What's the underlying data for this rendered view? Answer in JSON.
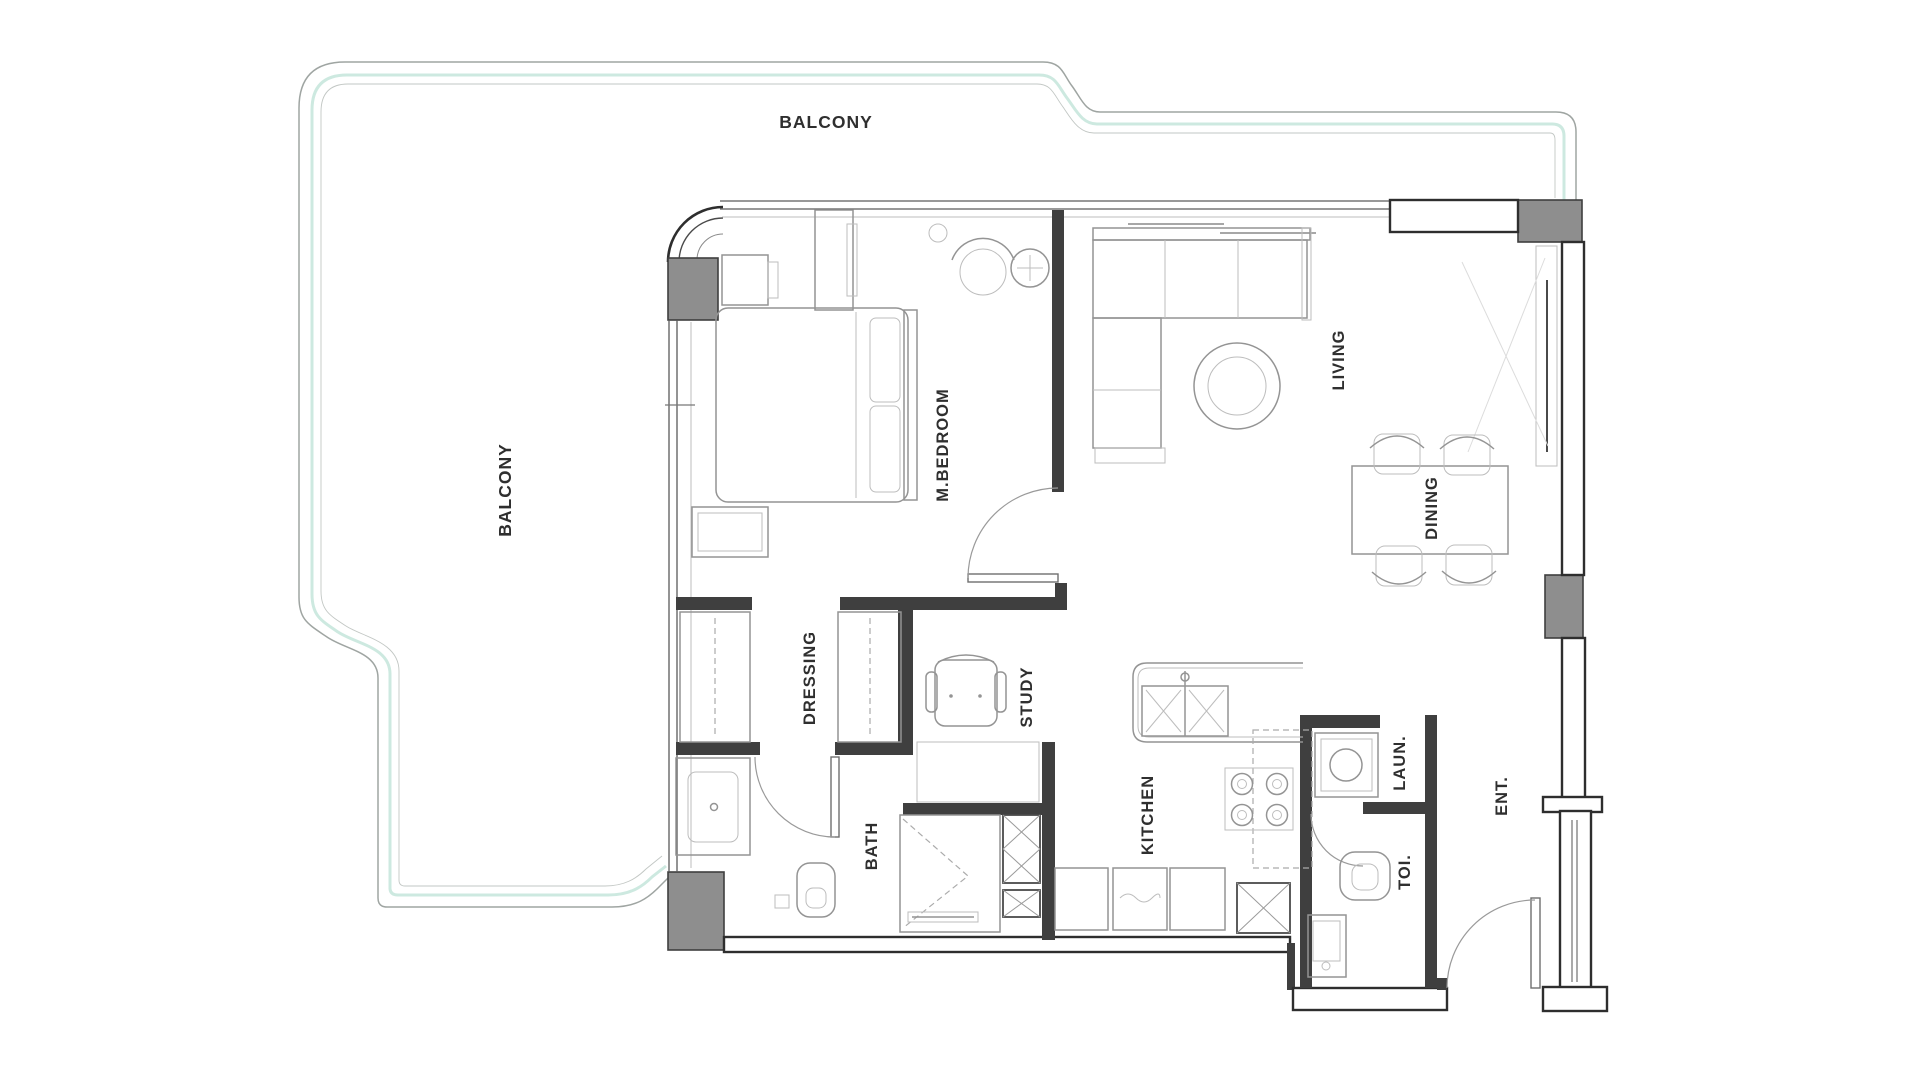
{
  "plan_type": "apartment-floor-plan",
  "rooms": [
    {
      "name": "balcony-top",
      "label": "BALCONY",
      "orientation": "horizontal"
    },
    {
      "name": "balcony-left",
      "label": "BALCONY",
      "orientation": "vertical"
    },
    {
      "name": "m-bedroom",
      "label": "M.BEDROOM",
      "orientation": "vertical"
    },
    {
      "name": "living",
      "label": "LIVING",
      "orientation": "vertical"
    },
    {
      "name": "dining",
      "label": "DINING",
      "orientation": "vertical"
    },
    {
      "name": "dressing",
      "label": "DRESSING",
      "orientation": "vertical"
    },
    {
      "name": "study",
      "label": "STUDY",
      "orientation": "vertical"
    },
    {
      "name": "bath",
      "label": "BATH",
      "orientation": "vertical"
    },
    {
      "name": "kitchen",
      "label": "KITCHEN",
      "orientation": "vertical"
    },
    {
      "name": "laundry",
      "label": "LAUN.",
      "orientation": "vertical"
    },
    {
      "name": "toilet",
      "label": "TOI.",
      "orientation": "vertical"
    },
    {
      "name": "entrance",
      "label": "ENT.",
      "orientation": "vertical"
    }
  ],
  "colors": {
    "background": "#ffffff",
    "wall": "#3f3f3f",
    "column_fill": "#8e8e8e",
    "balcony_rail_teal": "#cde9e0",
    "balcony_rail_gray": "#9fa5a2",
    "furniture_line": "#949494",
    "label_text": "#2f2f2f"
  }
}
